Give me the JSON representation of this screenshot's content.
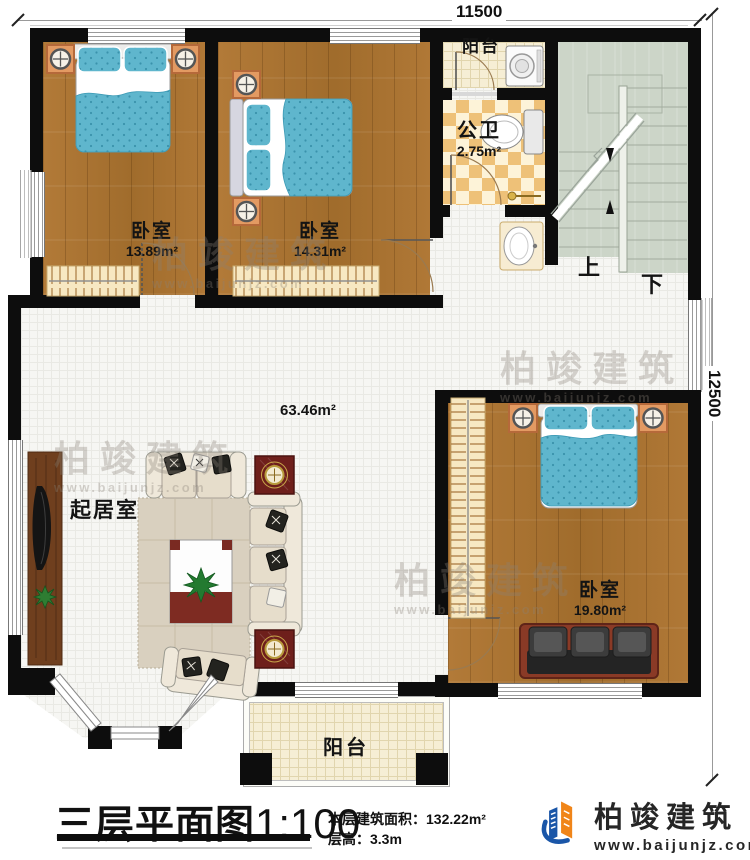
{
  "meta": {
    "type": "floor-plan",
    "floor": "三层",
    "scale": "1:100"
  },
  "dimensions": {
    "top": "11500",
    "right": "12500"
  },
  "rooms": {
    "bedroom1": {
      "name": "卧室",
      "area": "13.89m²"
    },
    "bedroom2": {
      "name": "卧室",
      "area": "14.31m²"
    },
    "bedroom3": {
      "name": "卧室",
      "area": "19.80m²"
    },
    "bathroom": {
      "name": "公卫",
      "area": "2.75m²"
    },
    "living": {
      "name": "起居室",
      "area": "63.46m²"
    },
    "balcony_top": {
      "name": "阳台"
    },
    "balcony_bottom": {
      "name": "阳台"
    }
  },
  "stairs": {
    "up": "上",
    "down": "下"
  },
  "title": {
    "text": "三层平面图",
    "scale": "1:100"
  },
  "info": {
    "area_label": "本层建筑面积：",
    "area_value": "132.22m²",
    "height_label": "层高：",
    "height_value": "3.3m"
  },
  "logo": {
    "name": "柏竣建筑",
    "url": "www.baijunjz.com"
  },
  "watermark": {
    "name": "柏竣建筑",
    "url": "www.baijunjz.com"
  },
  "colors": {
    "wall": "#0d0d0d",
    "wood": "#ad7433",
    "bed_blue": "#5fb6cd",
    "bath_tile": "#eec178",
    "stair": "#ccd5c8",
    "balcony": "#f6eed5",
    "logo_blue": "#1a56a8",
    "logo_orange": "#f08519"
  }
}
